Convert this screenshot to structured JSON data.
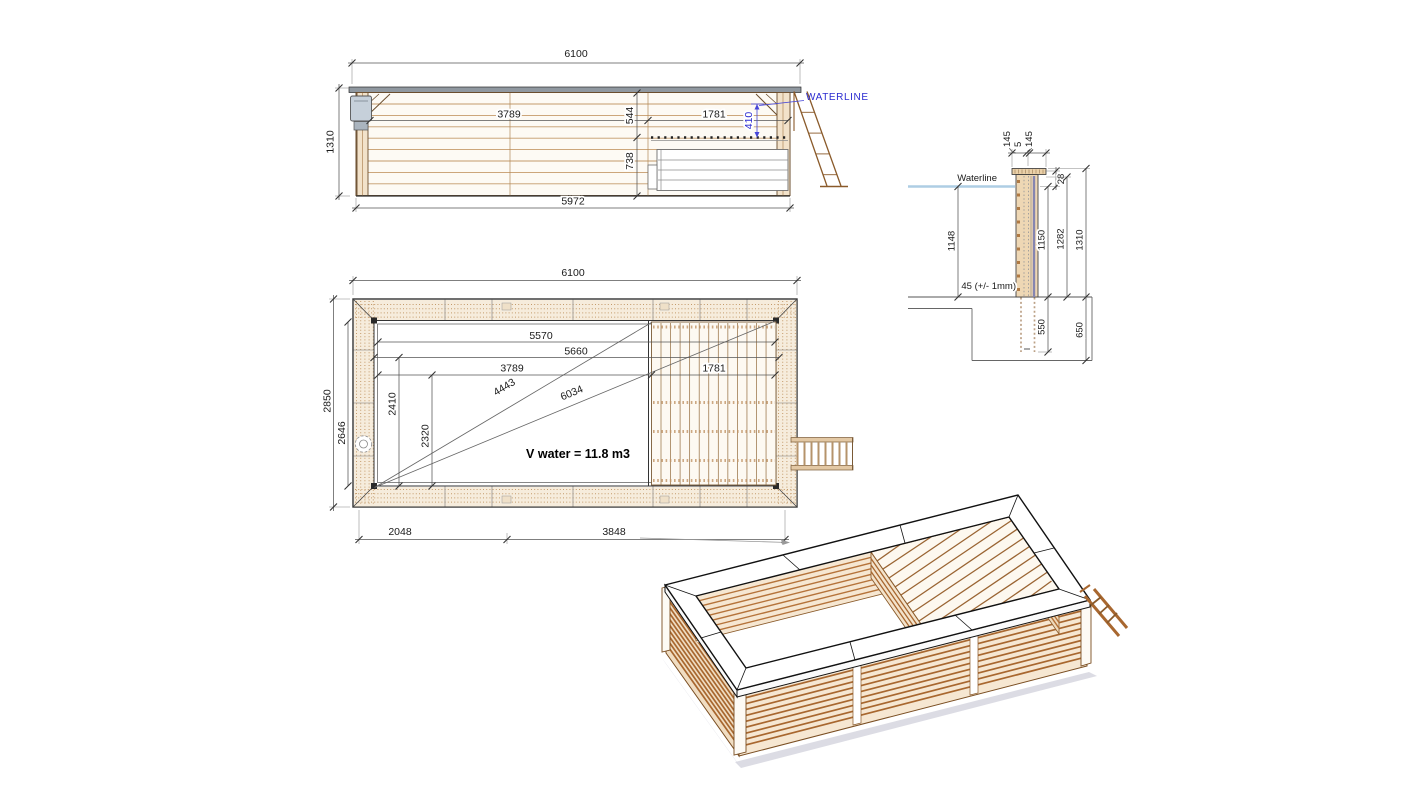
{
  "drawing": {
    "elevation": {
      "waterline_label": "WATERLINE",
      "dims": {
        "overall_width": "6100",
        "height": "1310",
        "base_width": "5972",
        "left_span": "3789",
        "right_span": "1781",
        "top_depth": "544",
        "bottom_depth": "738",
        "waterline_offset": "410"
      }
    },
    "plan": {
      "volume_label": "V water = 11.8 m3",
      "dims": {
        "overall_width": "6100",
        "overall_height": "2850",
        "inner_height": "2646",
        "inner_top": "5570",
        "inner_second": "5660",
        "water_length": "3789",
        "deck_length": "1781",
        "inner_width_a": "2410",
        "water_width": "2320",
        "diag_water": "4443",
        "diag_inner": "6034",
        "bottom_left": "2048",
        "bottom_right": "3848"
      }
    },
    "section": {
      "waterline_label": "Waterline",
      "tolerance_label": "45 (+/- 1mm)",
      "dims": {
        "cap_left": "145",
        "cap_gap": "5",
        "cap_right": "145",
        "top_offset": "28",
        "water_depth": "1148",
        "wall_inner": "1150",
        "wall_mid": "1282",
        "wall_total": "1310",
        "post_embed": "550",
        "foundation": "650"
      }
    }
  }
}
